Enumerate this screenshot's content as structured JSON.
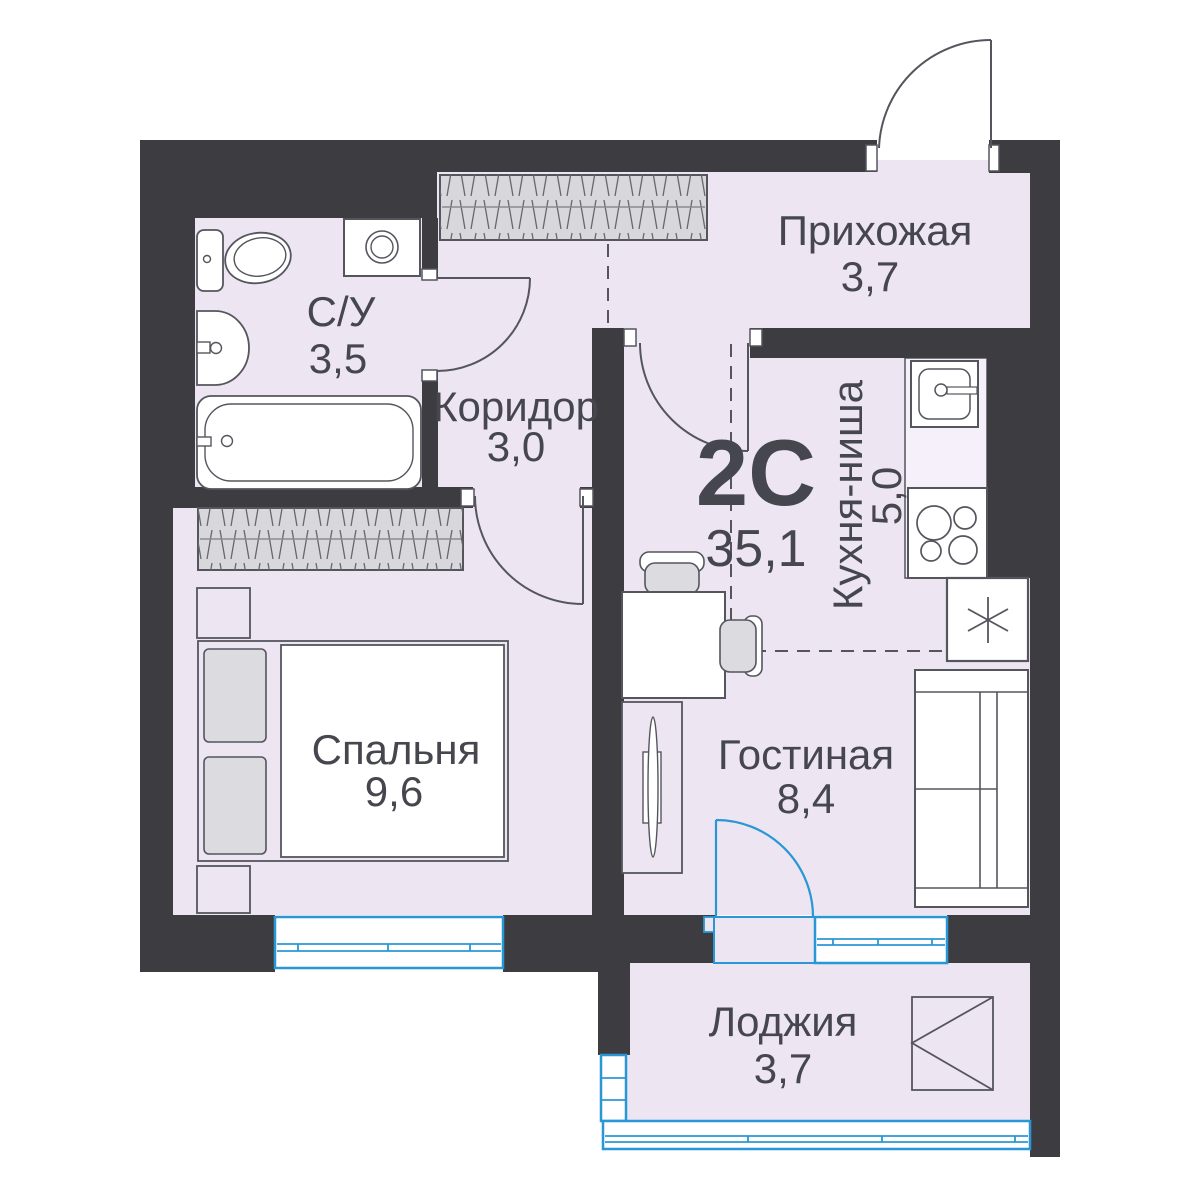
{
  "plan": {
    "type_label": "2С",
    "total_area": "35,1",
    "rooms": [
      {
        "key": "hallway",
        "name": "Прихожая",
        "area": "3,7"
      },
      {
        "key": "bathroom",
        "name": "С/У",
        "area": "3,5"
      },
      {
        "key": "corridor",
        "name": "Коридор",
        "area": "3,0"
      },
      {
        "key": "kitchen_niche",
        "name": "Кухня-ниша",
        "area": "5,0"
      },
      {
        "key": "bedroom",
        "name": "Спальня",
        "area": "9,6"
      },
      {
        "key": "living",
        "name": "Гостиная",
        "area": "8,4"
      },
      {
        "key": "loggia",
        "name": "Лоджия",
        "area": "3,7"
      }
    ],
    "colors": {
      "wall": "#3D3D41",
      "floor": "#EDE6F2",
      "window_blue": "#2997D6",
      "furniture_outline": "#55555E",
      "furniture_gray": "#DCDBE0",
      "text": "#46464E"
    }
  }
}
